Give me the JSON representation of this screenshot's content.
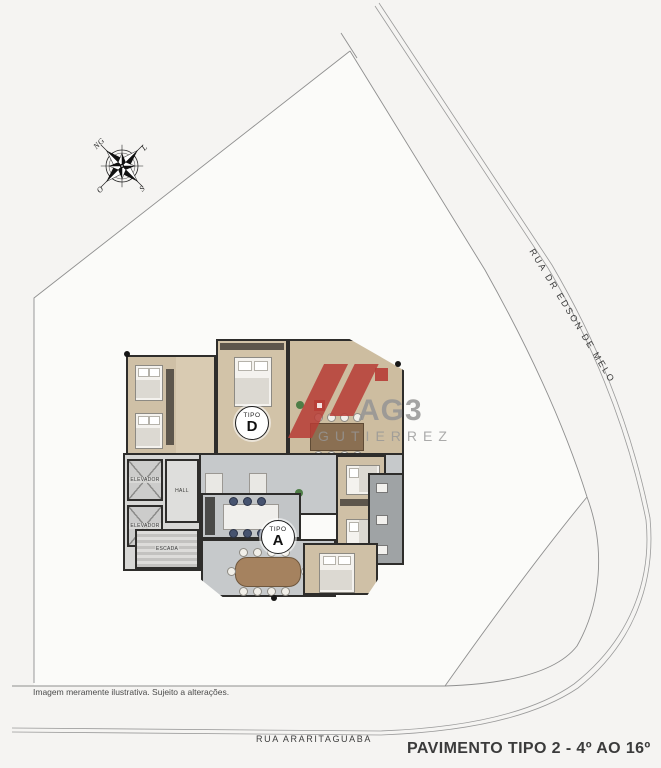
{
  "compass": {
    "labels": {
      "north": "NG",
      "east": "L",
      "south": "S",
      "west": "O"
    }
  },
  "streets": {
    "right_street": "RUA DR EDSON DE MELO",
    "bottom_street": "RUA ARARITAGUABA"
  },
  "floorplan": {
    "units": [
      {
        "prefix": "TIPO",
        "letter": "D"
      },
      {
        "prefix": "TIPO",
        "letter": "A"
      }
    ],
    "core": {
      "elevator_top": "ELEVADOR",
      "elevator_bottom": "ELEVADOR",
      "hall": "HALL",
      "stairs": "ESCADA"
    }
  },
  "watermark": {
    "brand": "AG3",
    "name": "GUTIERREZ",
    "red": "#b73c35",
    "gray": "#969696"
  },
  "footer": {
    "disclaimer": "Imagem meramente ilustrativa. Sujeito a alterações.",
    "plan_title": "PAVIMENTO TIPO 2 - 4º AO 16º"
  },
  "palette": {
    "background": "#f5f4f2",
    "lot_fill": "#fbfbf9",
    "boundary_line": "#8f8f8f",
    "wall": "#2e2d2b",
    "wood_floor": "#cfc0a6",
    "tile_floor": "#c6c9cb"
  }
}
